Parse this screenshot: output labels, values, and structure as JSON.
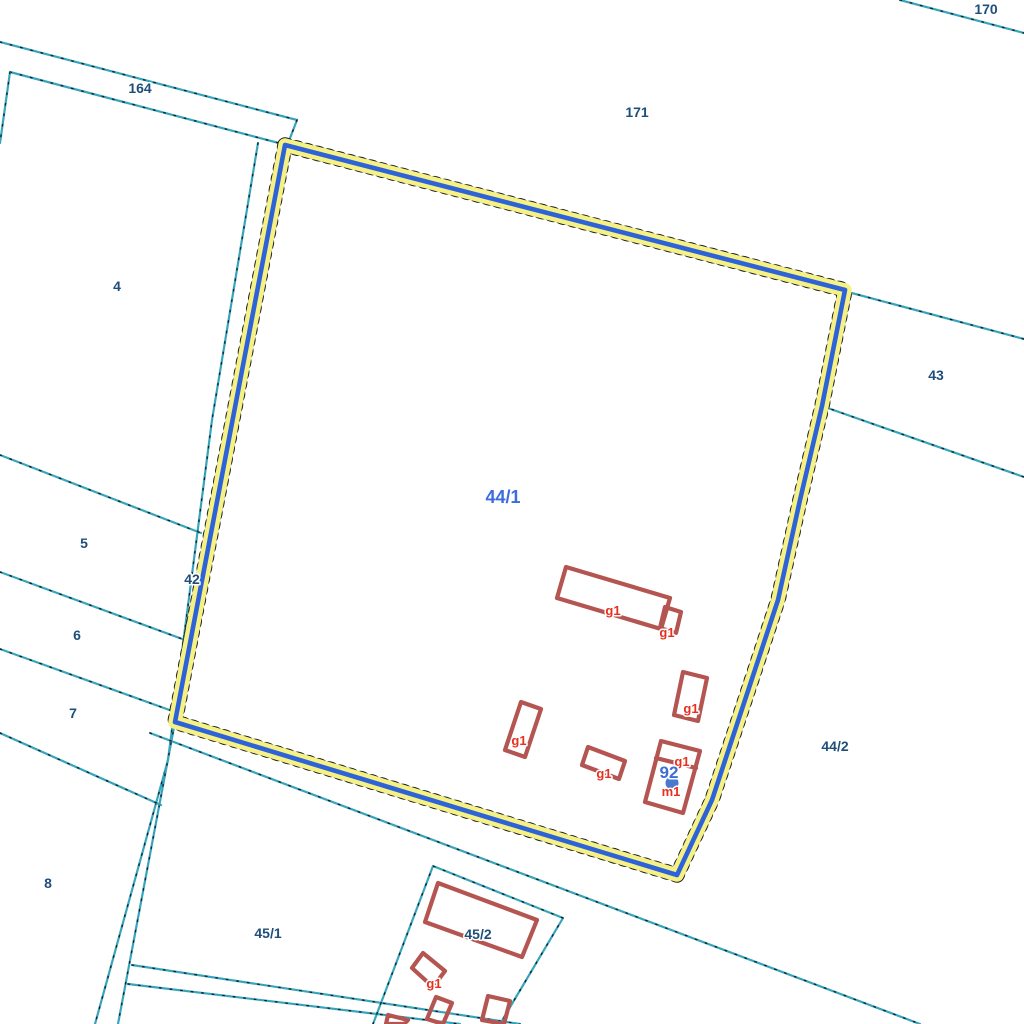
{
  "map": {
    "title": "cadastral-parcel-map",
    "background": "#ffffff",
    "colors": {
      "parcel_line": "#36A5BC",
      "parcel_line_dots": "#1a1a1a",
      "parcel_label": "#1F4E7A",
      "selected_label": "#3D6BE0",
      "highlight_halo": "#F5F185",
      "highlight_core": "#2E62D8",
      "building_outline": "#B55551",
      "building_label": "#E8301F",
      "address_label": "#3D6FD6",
      "address_dot": "#4978CE",
      "label_halo": "#FFFFFF"
    },
    "parcel_lines": [
      {
        "id": "boundary-170",
        "points": [
          [
            900,
            0
          ],
          [
            1024,
            33
          ]
        ]
      },
      {
        "id": "strip-164-top",
        "points": [
          [
            0,
            42
          ],
          [
            297,
            120
          ]
        ]
      },
      {
        "id": "strip-164-bottom",
        "points": [
          [
            10,
            72
          ],
          [
            290,
            146
          ]
        ]
      },
      {
        "id": "strip-164-left-cap",
        "points": [
          [
            10,
            72
          ],
          [
            0,
            143
          ]
        ]
      },
      {
        "id": "strip-164-right-cap",
        "points": [
          [
            297,
            120
          ],
          [
            287,
            146
          ]
        ]
      },
      {
        "id": "road-42-left-edge",
        "points": [
          [
            258,
            143
          ],
          [
            212,
            420
          ],
          [
            168,
            760
          ],
          [
            95,
            1024
          ]
        ]
      },
      {
        "id": "road-42-right-edge-lower",
        "points": [
          [
            175,
            722
          ],
          [
            118,
            1024
          ]
        ]
      },
      {
        "id": "divider-4-5",
        "points": [
          [
            0,
            455
          ],
          [
            201,
            533
          ]
        ]
      },
      {
        "id": "divider-5-6",
        "points": [
          [
            0,
            572
          ],
          [
            185,
            640
          ]
        ]
      },
      {
        "id": "divider-6-7",
        "points": [
          [
            0,
            649
          ],
          [
            175,
            712
          ]
        ]
      },
      {
        "id": "divider-7-8",
        "points": [
          [
            0,
            733
          ],
          [
            161,
            805
          ]
        ]
      },
      {
        "id": "boundary-45-1-top",
        "points": [
          [
            150,
            733
          ],
          [
            920,
            1024
          ]
        ]
      },
      {
        "id": "road-branch-upper",
        "points": [
          [
            132,
            965
          ],
          [
            520,
            1024
          ]
        ]
      },
      {
        "id": "road-branch-lower",
        "points": [
          [
            128,
            984
          ],
          [
            460,
            1024
          ]
        ]
      },
      {
        "id": "boundary-43-top",
        "points": [
          [
            848,
            292
          ],
          [
            1024,
            339
          ]
        ]
      },
      {
        "id": "boundary-43-bottom",
        "points": [
          [
            822,
            406
          ],
          [
            1024,
            477
          ]
        ]
      },
      {
        "id": "parcel-45-2-outline",
        "points": [
          [
            373,
            1024
          ],
          [
            433,
            866
          ],
          [
            563,
            918
          ],
          [
            500,
            1024
          ]
        ]
      }
    ],
    "highlighted_parcel": {
      "id": "44/1",
      "points": [
        [
          285,
          145
        ],
        [
          845,
          290
        ],
        [
          822,
          406
        ],
        [
          800,
          500
        ],
        [
          778,
          600
        ],
        [
          712,
          800
        ],
        [
          677,
          875
        ],
        [
          175,
          722
        ]
      ],
      "closed": true
    },
    "buildings": [
      {
        "id": "b-g1-long",
        "points": [
          [
            566,
            567
          ],
          [
            670,
            598
          ],
          [
            661,
            629
          ],
          [
            557,
            598
          ]
        ],
        "closed": true
      },
      {
        "id": "b-g1-annex",
        "points": [
          [
            665,
            607
          ],
          [
            681,
            612
          ],
          [
            676,
            633
          ],
          [
            660,
            628
          ]
        ],
        "closed": true
      },
      {
        "id": "b-g1-tall",
        "points": [
          [
            683,
            672
          ],
          [
            707,
            678
          ],
          [
            698,
            721
          ],
          [
            674,
            715
          ]
        ],
        "closed": true
      },
      {
        "id": "b-g1-narrow",
        "points": [
          [
            521,
            702
          ],
          [
            541,
            709
          ],
          [
            525,
            757
          ],
          [
            505,
            750
          ]
        ],
        "closed": true
      },
      {
        "id": "b-g1-small",
        "points": [
          [
            588,
            747
          ],
          [
            625,
            761
          ],
          [
            619,
            779
          ],
          [
            582,
            765
          ]
        ],
        "closed": true
      },
      {
        "id": "b-m1-outer",
        "points": [
          [
            661,
            741
          ],
          [
            700,
            751
          ],
          [
            683,
            813
          ],
          [
            645,
            802
          ]
        ],
        "closed": true
      },
      {
        "id": "b-m1-divider",
        "points": [
          [
            656,
            758
          ],
          [
            696,
            768
          ]
        ],
        "closed": false
      },
      {
        "id": "b-45-2-large",
        "points": [
          [
            438,
            883
          ],
          [
            537,
            920
          ],
          [
            522,
            957
          ],
          [
            425,
            922
          ]
        ],
        "closed": true
      },
      {
        "id": "b-45-2-g1",
        "points": [
          [
            423,
            953
          ],
          [
            445,
            971
          ],
          [
            433,
            987
          ],
          [
            412,
            968
          ]
        ],
        "closed": true
      },
      {
        "id": "b-45-2-s1",
        "points": [
          [
            436,
            997
          ],
          [
            452,
            1003
          ],
          [
            443,
            1024
          ],
          [
            427,
            1019
          ]
        ],
        "closed": true
      },
      {
        "id": "b-45-2-s2",
        "points": [
          [
            488,
            996
          ],
          [
            510,
            1001
          ],
          [
            504,
            1024
          ],
          [
            482,
            1020
          ]
        ],
        "closed": true
      },
      {
        "id": "b-45-2-s3",
        "points": [
          [
            388,
            1015
          ],
          [
            408,
            1020
          ],
          [
            404,
            1024
          ],
          [
            386,
            1024
          ]
        ],
        "closed": true
      }
    ],
    "parcel_labels": [
      {
        "text": "170",
        "x": 986,
        "y": 14
      },
      {
        "text": "164",
        "x": 140,
        "y": 93
      },
      {
        "text": "171",
        "x": 637,
        "y": 117
      },
      {
        "text": "4",
        "x": 117,
        "y": 291
      },
      {
        "text": "43",
        "x": 936,
        "y": 380
      },
      {
        "text": "5",
        "x": 84,
        "y": 548
      },
      {
        "text": "42",
        "x": 192,
        "y": 584
      },
      {
        "text": "6",
        "x": 77,
        "y": 640
      },
      {
        "text": "7",
        "x": 73,
        "y": 718
      },
      {
        "text": "44/2",
        "x": 835,
        "y": 751
      },
      {
        "text": "8",
        "x": 48,
        "y": 888
      },
      {
        "text": "45/1",
        "x": 268,
        "y": 938
      },
      {
        "text": "45/2",
        "x": 478,
        "y": 939
      }
    ],
    "selected_parcel_label": {
      "text": "44/1",
      "x": 503,
      "y": 503
    },
    "building_labels": [
      {
        "text": "g1",
        "x": 613,
        "y": 615
      },
      {
        "text": "g1",
        "x": 667,
        "y": 637
      },
      {
        "text": "g1",
        "x": 691,
        "y": 713
      },
      {
        "text": "g1",
        "x": 519,
        "y": 745
      },
      {
        "text": "g1",
        "x": 604,
        "y": 778
      },
      {
        "text": "g1",
        "x": 682,
        "y": 766
      },
      {
        "text": "g1",
        "x": 434,
        "y": 988
      },
      {
        "text": "m1",
        "x": 671,
        "y": 796
      }
    ],
    "address_marker": {
      "text": "92",
      "x": 669,
      "y": 778,
      "dot_x": 672,
      "dot_y": 783,
      "dot_r": 7
    }
  }
}
